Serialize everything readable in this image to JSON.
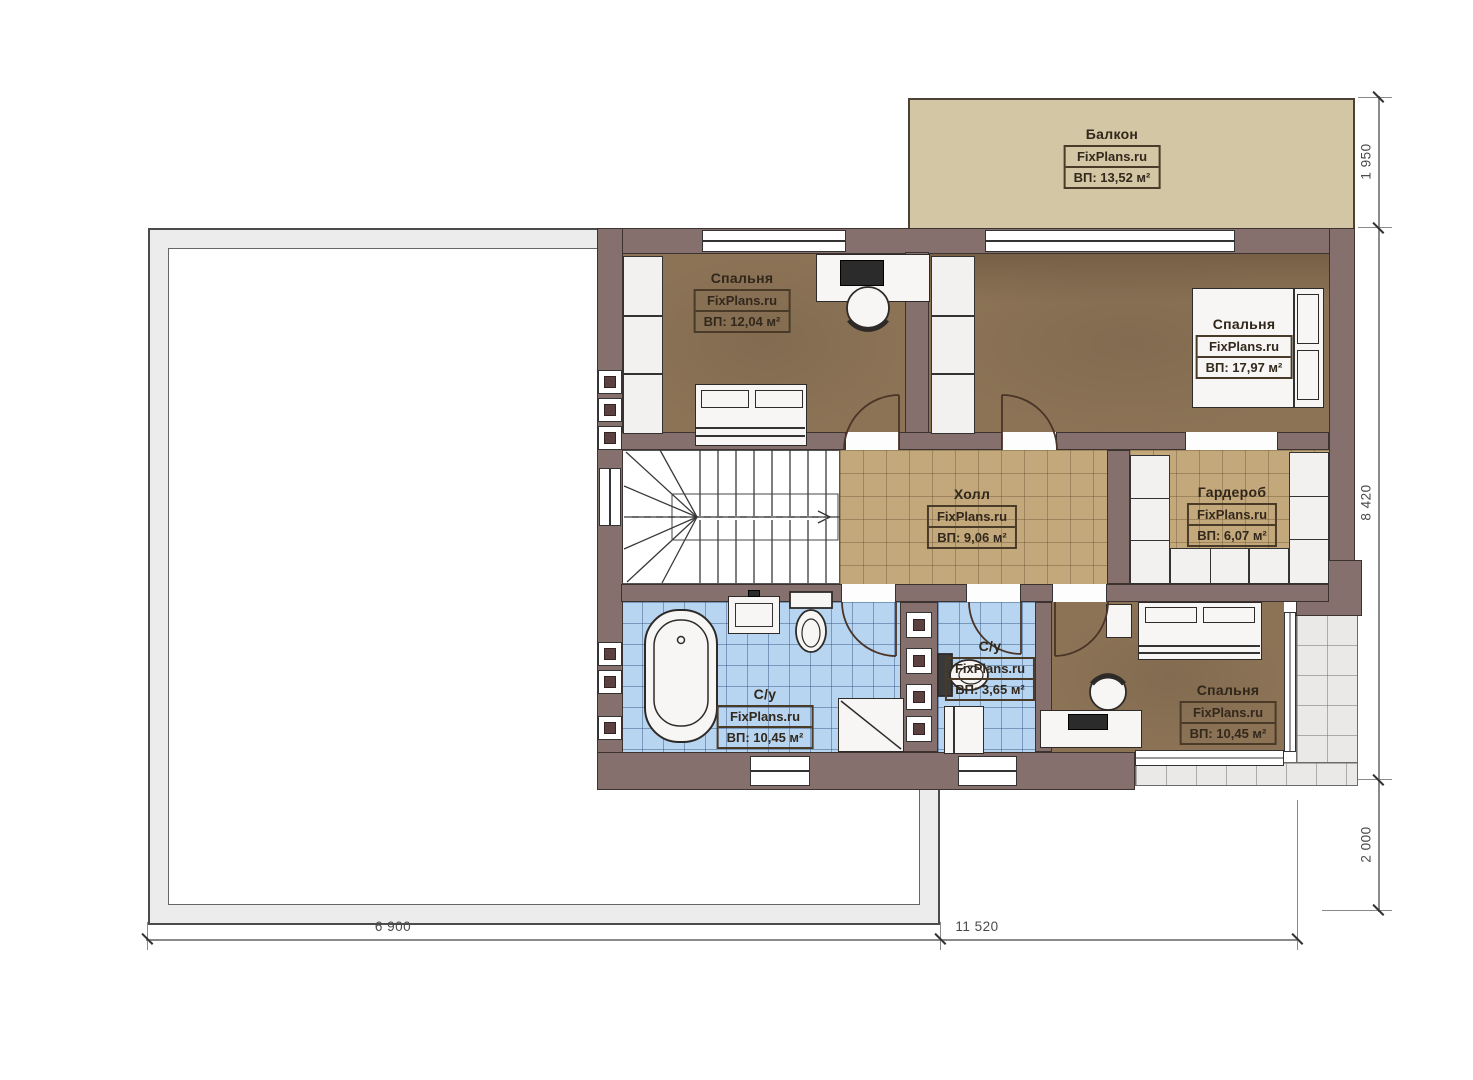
{
  "watermark": "FixPlans.ru",
  "rooms": {
    "balcony": {
      "name": "Балкон",
      "area": "ВП: 13,52 м²"
    },
    "bedroom_top_left": {
      "name": "Спальня",
      "area": "ВП: 12,04 м²"
    },
    "bedroom_top_right": {
      "name": "Спальня",
      "area": "ВП: 17,97 м²"
    },
    "hall": {
      "name": "Холл",
      "area": "ВП: 9,06 м²"
    },
    "wardrobe": {
      "name": "Гардероб",
      "area": "ВП: 6,07 м²"
    },
    "bathroom_main": {
      "name": "С/у",
      "area": "ВП: 10,45 м²"
    },
    "bathroom_small": {
      "name": "С/у",
      "area": "ВП: 3,65 м²"
    },
    "bedroom_bottom_right": {
      "name": "Спальня",
      "area": "ВП: 10,45 м²"
    }
  },
  "dimensions": {
    "balcony_depth": "1 950",
    "house_depth": "8 420",
    "terrace_drop": "2 000",
    "terrace_width": "6 900",
    "house_width": "11 520"
  },
  "colors": {
    "wall": "#85706e",
    "bedroom_floor": "#8c7356",
    "hall_tile": "#c3a87c",
    "bath_tile": "#b7d4f0",
    "balcony_floor": "#d3c6a4",
    "terrace_band": "#ececec"
  }
}
